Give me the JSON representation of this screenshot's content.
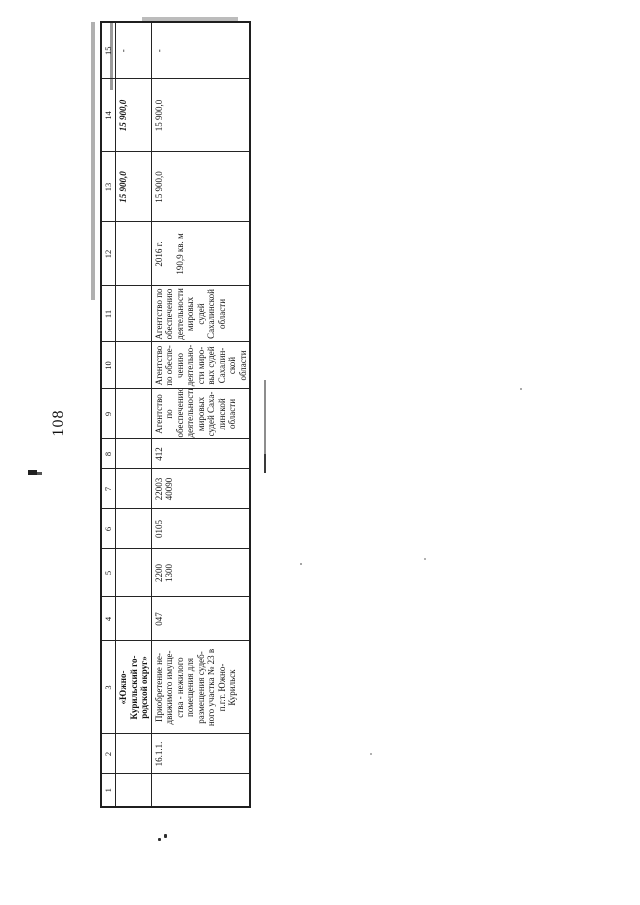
{
  "page": {
    "number": "108"
  },
  "table": {
    "header": [
      "1",
      "2",
      "3",
      "4",
      "5",
      "6",
      "7",
      "8",
      "9",
      "10",
      "11",
      "12",
      "13",
      "14",
      "15"
    ],
    "row_a": {
      "c3": "«Южно-\nКурильский го-\nродской округ»",
      "c13": "15 900,0",
      "c14": "15 900,0",
      "c15": "-"
    },
    "row_b": {
      "c2": "16.1.1.",
      "c3": "Приобретение не-\nдвижимого имуще-\nства - нежилого\nпомещения для\nразмещения судеб-\nного участка № 23 в\nп.г.т. Южно-\nКурильск",
      "c4": "047",
      "c5": "2200\n1300",
      "c6": "0105",
      "c7": "22003\n40090",
      "c8": "412",
      "c9": "Агентство по\nобеспечению\nдеятельности\nмировых\nсудей Саха-\nлинской\nобласти",
      "c10": "Агентство\nпо обеспе-\nчению\nдеятельно-\nсти миро-\nвых судей\nСахалин-\nской\nобласти",
      "c11": "Агентство по\nобеспечению\nдеятельности\nмировых судей\nСахалинской\nобласти",
      "c12": "2016 г.\n\n190,9 кв. м",
      "c13": "15 900,0",
      "c14": "15 900,0",
      "c15": "-"
    }
  }
}
